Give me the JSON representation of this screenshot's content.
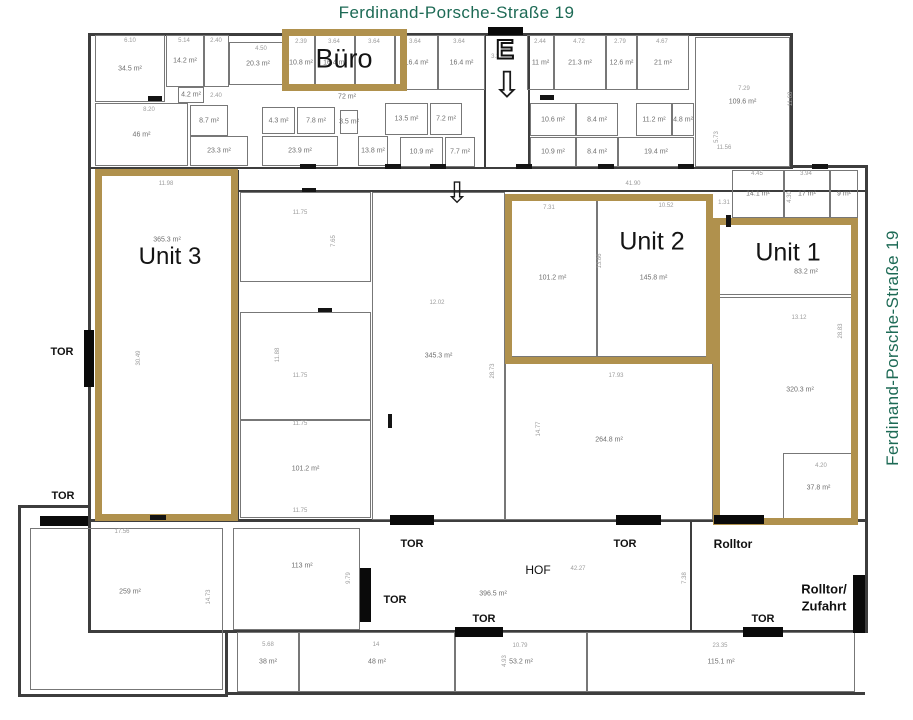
{
  "title_top": "Ferdinand-Porsche-Straße 19",
  "title_right": "Ferdinand-Porsche-Straße 19",
  "colors": {
    "accent_gold": "#b0914d",
    "street_green": "#1d6a55",
    "wall": "#3d3d3d",
    "gate": "#0a0a0a"
  },
  "zones": [
    {
      "id": "buero",
      "label": "Büro",
      "x": 282,
      "y": 29,
      "w": 125,
      "h": 62,
      "label_cx": 344,
      "label_cy": 59,
      "label_size": 27,
      "area": null,
      "area_cx": null,
      "area_cy": null
    },
    {
      "id": "unit-3",
      "label": "Unit 3",
      "x": 95,
      "y": 169,
      "w": 143,
      "h": 352,
      "label_cx": 170,
      "label_cy": 257,
      "label_size": 24,
      "area": "365.3 m²",
      "area_cx": 167,
      "area_cy": 240
    },
    {
      "id": "unit-2",
      "label": "Unit 2",
      "x": 505,
      "y": 194,
      "w": 208,
      "h": 170,
      "label_cx": 652,
      "label_cy": 242,
      "label_size": 25,
      "area": null,
      "area_cx": null,
      "area_cy": null
    },
    {
      "id": "unit-1",
      "label": "Unit 1",
      "x": 713,
      "y": 218,
      "w": 145,
      "h": 307,
      "label_cx": 788,
      "label_cy": 253,
      "label_size": 25,
      "area": "83.2 m²",
      "area_cx": 806,
      "area_cy": 272
    }
  ],
  "rooms": [
    {
      "label": "34.5 m²",
      "x": 95,
      "y": 35,
      "w": 70,
      "h": 67
    },
    {
      "label": "14.2 m²",
      "x": 166,
      "y": 35,
      "w": 38,
      "h": 52
    },
    {
      "label": "",
      "x": 204,
      "y": 35,
      "w": 25,
      "h": 52
    },
    {
      "label": "20.3 m²",
      "x": 229,
      "y": 42,
      "w": 58,
      "h": 43
    },
    {
      "label": "10.8 m²",
      "x": 287,
      "y": 35,
      "w": 28,
      "h": 55
    },
    {
      "label": "16.4 m²",
      "x": 315,
      "y": 35,
      "w": 40,
      "h": 55
    },
    {
      "label": "",
      "x": 355,
      "y": 35,
      "w": 40,
      "h": 55
    },
    {
      "label": "16.4 m²",
      "x": 395,
      "y": 35,
      "w": 43,
      "h": 55
    },
    {
      "label": "16.4 m²",
      "x": 438,
      "y": 35,
      "w": 47,
      "h": 55
    },
    {
      "label": "11 m²",
      "x": 527,
      "y": 35,
      "w": 27,
      "h": 55
    },
    {
      "label": "21.3 m²",
      "x": 554,
      "y": 35,
      "w": 52,
      "h": 55
    },
    {
      "label": "12.6 m²",
      "x": 606,
      "y": 35,
      "w": 31,
      "h": 55
    },
    {
      "label": "21 m²",
      "x": 637,
      "y": 35,
      "w": 52,
      "h": 55
    },
    {
      "label": "109.6 m²",
      "x": 695,
      "y": 37,
      "w": 95,
      "h": 130
    },
    {
      "label": "46 m²",
      "x": 95,
      "y": 103,
      "w": 93,
      "h": 63
    },
    {
      "label": "4.2 m²",
      "x": 178,
      "y": 87,
      "w": 26,
      "h": 16
    },
    {
      "label": "8.7 m²",
      "x": 190,
      "y": 105,
      "w": 38,
      "h": 31
    },
    {
      "label": "23.3 m²",
      "x": 190,
      "y": 136,
      "w": 58,
      "h": 30
    },
    {
      "label": "4.3 m²",
      "x": 262,
      "y": 107,
      "w": 33,
      "h": 27
    },
    {
      "label": "7.8 m²",
      "x": 297,
      "y": 107,
      "w": 38,
      "h": 27
    },
    {
      "label": "23.9 m²",
      "x": 262,
      "y": 136,
      "w": 76,
      "h": 30
    },
    {
      "label": "3.5 m²",
      "x": 340,
      "y": 110,
      "w": 18,
      "h": 24
    },
    {
      "label": "13.8 m²",
      "x": 358,
      "y": 136,
      "w": 30,
      "h": 30
    },
    {
      "label": "13.5 m²",
      "x": 385,
      "y": 103,
      "w": 43,
      "h": 32
    },
    {
      "label": "7.2 m²",
      "x": 430,
      "y": 103,
      "w": 32,
      "h": 32
    },
    {
      "label": "10.9 m²",
      "x": 400,
      "y": 137,
      "w": 43,
      "h": 30
    },
    {
      "label": "7.7 m²",
      "x": 445,
      "y": 137,
      "w": 30,
      "h": 30
    },
    {
      "label": "10.6 m²",
      "x": 530,
      "y": 103,
      "w": 46,
      "h": 33
    },
    {
      "label": "8.4 m²",
      "x": 576,
      "y": 103,
      "w": 42,
      "h": 33
    },
    {
      "label": "11.2 m²",
      "x": 636,
      "y": 103,
      "w": 36,
      "h": 33
    },
    {
      "label": "4.8 m²",
      "x": 672,
      "y": 103,
      "w": 22,
      "h": 33
    },
    {
      "label": "10.9 m²",
      "x": 530,
      "y": 137,
      "w": 46,
      "h": 30
    },
    {
      "label": "8.4 m²",
      "x": 576,
      "y": 137,
      "w": 42,
      "h": 30
    },
    {
      "label": "19.4 m²",
      "x": 618,
      "y": 137,
      "w": 76,
      "h": 30
    },
    {
      "label": "14.1 m²",
      "x": 732,
      "y": 170,
      "w": 52,
      "h": 48
    },
    {
      "label": "17 m²",
      "x": 784,
      "y": 170,
      "w": 46,
      "h": 48
    },
    {
      "label": "9 m²",
      "x": 830,
      "y": 170,
      "w": 28,
      "h": 48
    },
    {
      "label": "",
      "x": 240,
      "y": 192,
      "w": 131,
      "h": 90
    },
    {
      "label": "",
      "x": 240,
      "y": 312,
      "w": 131,
      "h": 108
    },
    {
      "label": "101.2 m²",
      "x": 240,
      "y": 420,
      "w": 131,
      "h": 98
    },
    {
      "label": "345.3 m²",
      "x": 372,
      "y": 192,
      "w": 133,
      "h": 328
    },
    {
      "label": "264.8 m²",
      "x": 505,
      "y": 360,
      "w": 208,
      "h": 160
    },
    {
      "label": "101.2 m²",
      "x": 508,
      "y": 199,
      "w": 89,
      "h": 158
    },
    {
      "label": "145.8 m²",
      "x": 597,
      "y": 199,
      "w": 113,
      "h": 158
    },
    {
      "label": "",
      "x": 98,
      "y": 173,
      "w": 136,
      "h": 344
    },
    {
      "label": "",
      "x": 718,
      "y": 222,
      "w": 136,
      "h": 73
    },
    {
      "label": "320.3 m²",
      "x": 718,
      "y": 297,
      "w": 136,
      "h": 222,
      "lx": 800,
      "ly": 390
    },
    {
      "label": "37.8 m²",
      "x": 783,
      "y": 453,
      "w": 71,
      "h": 69
    },
    {
      "label": "259 m²",
      "x": 30,
      "y": 528,
      "w": 193,
      "h": 162,
      "lx": 130,
      "ly": 592
    },
    {
      "label": "113 m²",
      "x": 233,
      "y": 528,
      "w": 127,
      "h": 102,
      "lx": 302,
      "ly": 566
    },
    {
      "label": "38 m²",
      "x": 237,
      "y": 632,
      "w": 62,
      "h": 60
    },
    {
      "label": "48 m²",
      "x": 299,
      "y": 632,
      "w": 156,
      "h": 60
    },
    {
      "label": "53.2 m²",
      "x": 455,
      "y": 632,
      "w": 132,
      "h": 60
    },
    {
      "label": "115.1 m²",
      "x": 587,
      "y": 632,
      "w": 268,
      "h": 60
    }
  ],
  "walls": [
    {
      "x": 88,
      "y": 33,
      "w": 705,
      "h": 3
    },
    {
      "x": 88,
      "y": 33,
      "w": 3,
      "h": 597
    },
    {
      "x": 790,
      "y": 33,
      "w": 3,
      "h": 135
    },
    {
      "x": 790,
      "y": 165,
      "w": 78,
      "h": 3
    },
    {
      "x": 865,
      "y": 165,
      "w": 3,
      "h": 468
    },
    {
      "x": 88,
      "y": 167,
      "w": 705,
      "h": 2
    },
    {
      "x": 237,
      "y": 190,
      "w": 631,
      "h": 2
    },
    {
      "x": 237,
      "y": 170,
      "w": 2,
      "h": 350
    },
    {
      "x": 484,
      "y": 35,
      "w": 2,
      "h": 133
    },
    {
      "x": 528,
      "y": 35,
      "w": 2,
      "h": 133
    },
    {
      "x": 88,
      "y": 519,
      "w": 780,
      "h": 3
    },
    {
      "x": 88,
      "y": 630,
      "w": 780,
      "h": 3
    },
    {
      "x": 690,
      "y": 522,
      "w": 2,
      "h": 108
    },
    {
      "x": 18,
      "y": 505,
      "w": 73,
      "h": 3
    },
    {
      "x": 18,
      "y": 505,
      "w": 3,
      "h": 192
    },
    {
      "x": 18,
      "y": 694,
      "w": 210,
      "h": 3
    },
    {
      "x": 225,
      "y": 630,
      "w": 3,
      "h": 65
    },
    {
      "x": 225,
      "y": 692,
      "w": 640,
      "h": 3
    }
  ],
  "gates": [
    {
      "x": 488,
      "y": 27,
      "w": 35,
      "h": 8
    },
    {
      "x": 84,
      "y": 330,
      "w": 10,
      "h": 57
    },
    {
      "x": 40,
      "y": 516,
      "w": 48,
      "h": 10
    },
    {
      "x": 390,
      "y": 515,
      "w": 44,
      "h": 10
    },
    {
      "x": 616,
      "y": 515,
      "w": 45,
      "h": 10
    },
    {
      "x": 714,
      "y": 515,
      "w": 50,
      "h": 9
    },
    {
      "x": 455,
      "y": 627,
      "w": 48,
      "h": 10
    },
    {
      "x": 743,
      "y": 627,
      "w": 40,
      "h": 10
    },
    {
      "x": 360,
      "y": 568,
      "w": 11,
      "h": 54
    },
    {
      "x": 853,
      "y": 575,
      "w": 12,
      "h": 58
    }
  ],
  "door_marks": [
    {
      "x": 300,
      "y": 164,
      "w": 16,
      "h": 5
    },
    {
      "x": 385,
      "y": 164,
      "w": 16,
      "h": 5
    },
    {
      "x": 430,
      "y": 164,
      "w": 16,
      "h": 5
    },
    {
      "x": 516,
      "y": 164,
      "w": 16,
      "h": 5
    },
    {
      "x": 598,
      "y": 164,
      "w": 16,
      "h": 5
    },
    {
      "x": 678,
      "y": 164,
      "w": 16,
      "h": 5
    },
    {
      "x": 812,
      "y": 164,
      "w": 16,
      "h": 5
    },
    {
      "x": 148,
      "y": 96,
      "w": 14,
      "h": 5
    },
    {
      "x": 540,
      "y": 95,
      "w": 14,
      "h": 5
    },
    {
      "x": 302,
      "y": 188,
      "w": 14,
      "h": 4
    },
    {
      "x": 318,
      "y": 308,
      "w": 14,
      "h": 4
    },
    {
      "x": 150,
      "y": 515,
      "w": 16,
      "h": 5
    },
    {
      "x": 388,
      "y": 414,
      "w": 4,
      "h": 14
    },
    {
      "x": 726,
      "y": 215,
      "w": 5,
      "h": 12
    }
  ],
  "labels": [
    {
      "text": "TOR",
      "x": 62,
      "y": 352,
      "bold": true,
      "size": 11
    },
    {
      "text": "TOR",
      "x": 63,
      "y": 496,
      "bold": true,
      "size": 11
    },
    {
      "text": "TOR",
      "x": 412,
      "y": 544,
      "bold": true,
      "size": 11
    },
    {
      "text": "TOR",
      "x": 625,
      "y": 544,
      "bold": true,
      "size": 11
    },
    {
      "text": "Rolltor",
      "x": 733,
      "y": 544,
      "bold": true,
      "size": 12
    },
    {
      "text": "TOR",
      "x": 395,
      "y": 600,
      "bold": true,
      "size": 11
    },
    {
      "text": "TOR",
      "x": 484,
      "y": 619,
      "bold": true,
      "size": 11
    },
    {
      "text": "TOR",
      "x": 763,
      "y": 619,
      "bold": true,
      "size": 11
    },
    {
      "text": "Rolltor/",
      "x": 824,
      "y": 589,
      "bold": true,
      "size": 13
    },
    {
      "text": "Zufahrt",
      "x": 824,
      "y": 606,
      "bold": true,
      "size": 13
    },
    {
      "text": "HOF",
      "x": 538,
      "y": 570,
      "bold": false,
      "size": 12
    },
    {
      "text": "396.5 m²",
      "x": 493,
      "y": 594,
      "bold": false,
      "size": 7
    },
    {
      "text": "72 m²",
      "x": 347,
      "y": 97,
      "bold": false,
      "size": 7
    }
  ],
  "dims": [
    {
      "t": "6.10",
      "x": 130,
      "y": 41
    },
    {
      "t": "5.14",
      "x": 184,
      "y": 41
    },
    {
      "t": "2.40",
      "x": 216,
      "y": 41
    },
    {
      "t": "4.50",
      "x": 261,
      "y": 49
    },
    {
      "t": "2.39",
      "x": 301,
      "y": 42
    },
    {
      "t": "3.64",
      "x": 334,
      "y": 42
    },
    {
      "t": "3.64",
      "x": 374,
      "y": 42
    },
    {
      "t": "3.64",
      "x": 415,
      "y": 42
    },
    {
      "t": "3.64",
      "x": 459,
      "y": 42
    },
    {
      "t": "3.34",
      "x": 497,
      "y": 57
    },
    {
      "t": "2.44",
      "x": 540,
      "y": 42
    },
    {
      "t": "4.72",
      "x": 579,
      "y": 42
    },
    {
      "t": "2.79",
      "x": 620,
      "y": 42
    },
    {
      "t": "4.67",
      "x": 662,
      "y": 42
    },
    {
      "t": "7.29",
      "x": 744,
      "y": 89
    },
    {
      "t": "11.68",
      "x": 791,
      "y": 99,
      "r": true
    },
    {
      "t": "11.56",
      "x": 724,
      "y": 148
    },
    {
      "t": "5.73",
      "x": 717,
      "y": 137,
      "r": true
    },
    {
      "t": "8.20",
      "x": 149,
      "y": 110
    },
    {
      "t": "2.40",
      "x": 216,
      "y": 96
    },
    {
      "t": "4.45",
      "x": 757,
      "y": 174
    },
    {
      "t": "3.94",
      "x": 806,
      "y": 174
    },
    {
      "t": "4.30",
      "x": 790,
      "y": 197,
      "r": true
    },
    {
      "t": "1.31",
      "x": 724,
      "y": 203
    },
    {
      "t": "41.90",
      "x": 633,
      "y": 184
    },
    {
      "t": "11.98",
      "x": 166,
      "y": 184
    },
    {
      "t": "30.49",
      "x": 139,
      "y": 358,
      "r": true
    },
    {
      "t": "11.75",
      "x": 300,
      "y": 213
    },
    {
      "t": "7.65",
      "x": 334,
      "y": 241,
      "r": true
    },
    {
      "t": "11.75",
      "x": 300,
      "y": 376
    },
    {
      "t": "11.88",
      "x": 278,
      "y": 355,
      "r": true
    },
    {
      "t": "11.75",
      "x": 300,
      "y": 424
    },
    {
      "t": "11.75",
      "x": 300,
      "y": 511
    },
    {
      "t": "12.02",
      "x": 437,
      "y": 303
    },
    {
      "t": "28.73",
      "x": 493,
      "y": 371,
      "r": true
    },
    {
      "t": "7.31",
      "x": 549,
      "y": 208
    },
    {
      "t": "10.52",
      "x": 666,
      "y": 206
    },
    {
      "t": "13.86",
      "x": 600,
      "y": 261,
      "r": true
    },
    {
      "t": "17.93",
      "x": 616,
      "y": 376
    },
    {
      "t": "14.77",
      "x": 539,
      "y": 429,
      "r": true
    },
    {
      "t": "13.12",
      "x": 799,
      "y": 318
    },
    {
      "t": "28.83",
      "x": 841,
      "y": 331,
      "r": true
    },
    {
      "t": "4.20",
      "x": 821,
      "y": 466
    },
    {
      "t": "42.27",
      "x": 578,
      "y": 569
    },
    {
      "t": "7.38",
      "x": 685,
      "y": 578,
      "r": true
    },
    {
      "t": "9.79",
      "x": 349,
      "y": 578,
      "r": true
    },
    {
      "t": "17.56",
      "x": 122,
      "y": 532
    },
    {
      "t": "14.73",
      "x": 209,
      "y": 597,
      "r": true
    },
    {
      "t": "5.68",
      "x": 268,
      "y": 645
    },
    {
      "t": "14",
      "x": 376,
      "y": 645
    },
    {
      "t": "10.79",
      "x": 520,
      "y": 646
    },
    {
      "t": "23.35",
      "x": 720,
      "y": 646
    },
    {
      "t": "4.93",
      "x": 505,
      "y": 661,
      "r": true
    }
  ],
  "entrance": {
    "glyph": "E",
    "x": 505,
    "y": 50,
    "arrows": [
      {
        "glyph": "⇩",
        "x": 507,
        "y": 85,
        "size": 36
      },
      {
        "glyph": "⇩",
        "x": 457,
        "y": 194,
        "size": 29
      }
    ]
  }
}
